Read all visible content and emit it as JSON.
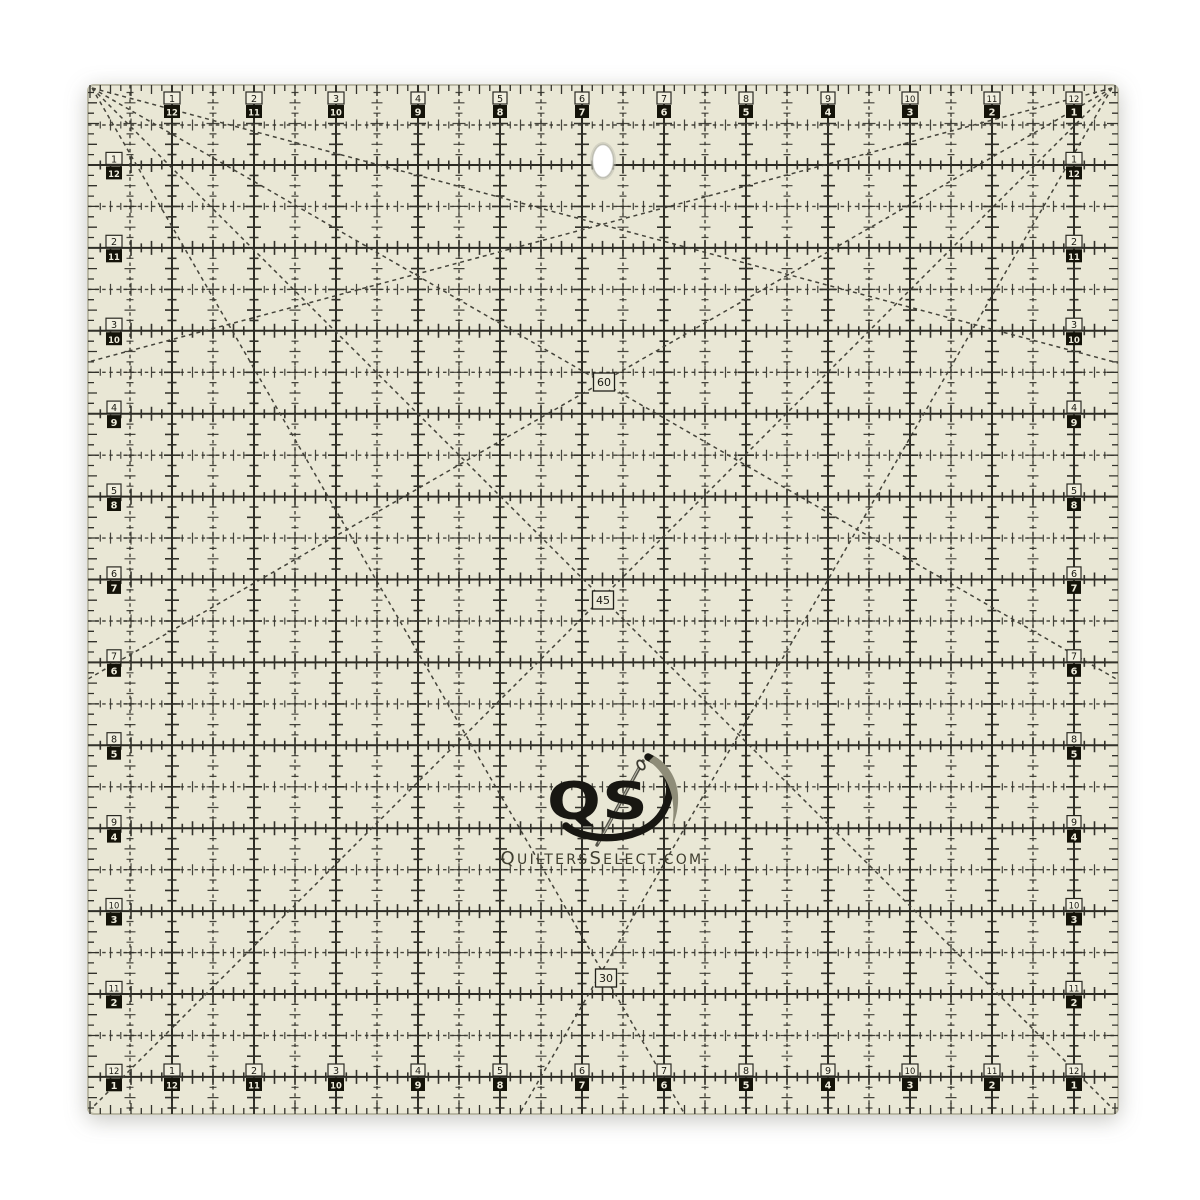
{
  "page": {
    "background": "#ffffff"
  },
  "product": {
    "type": "square quilting ruler product photo"
  },
  "ruler": {
    "inch_numbers_forward": [
      1,
      2,
      3,
      4,
      5,
      6,
      7,
      8,
      9,
      10,
      11,
      12
    ],
    "inch_numbers_reverse": [
      12,
      11,
      10,
      9,
      8,
      7,
      6,
      5,
      4,
      3,
      2,
      1
    ],
    "angle_markers": [
      {
        "label": "60"
      },
      {
        "label": "45"
      },
      {
        "label": "30"
      }
    ],
    "colors": {
      "body": "#e9e7d5",
      "edge": "#b9b7a4",
      "grid_line": "#2b2a23",
      "dash_line": "#44433a",
      "tick": "#33322b",
      "box_light_fill": "#f0eede",
      "box_dark_fill": "#141309",
      "digit_dark": "#1a1912",
      "digit_light": "#f0eede",
      "marker_fill": "#ecead9",
      "marker_stroke": "#21201a"
    }
  },
  "logo": {
    "monogram": "QS",
    "website": "QuiltersSelect.com",
    "monogram_color": "#181712",
    "swoosh_color": "#8e8c78",
    "website_color": "#3f3d2f",
    "needle_color": "#55544a",
    "needle_highlight": "#d9d8c8",
    "eye_fill": "#f4f2e4"
  }
}
